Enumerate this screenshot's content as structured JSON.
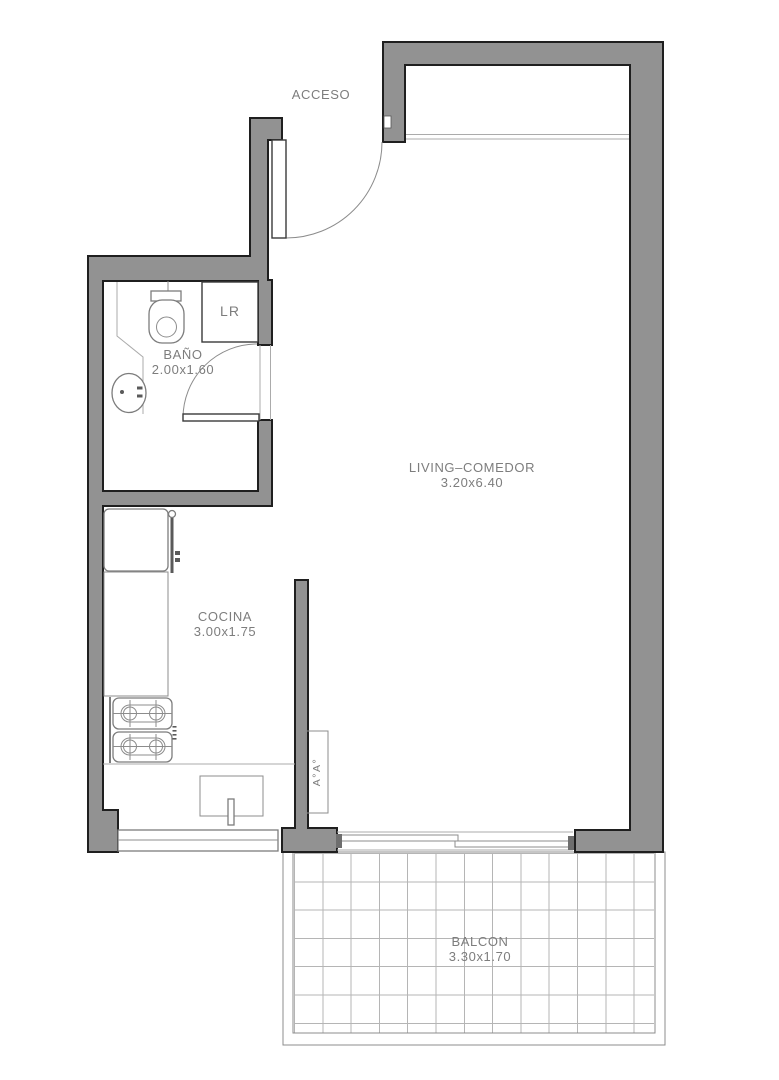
{
  "plan": {
    "entry_label": "ACCESO",
    "rooms": {
      "bathroom": {
        "name": "BAÑO",
        "dims": "2.00x1.60"
      },
      "living": {
        "name": "LIVING–COMEDOR",
        "dims": "3.20x6.40"
      },
      "kitchen": {
        "name": "COCINA",
        "dims": "3.00x1.75"
      },
      "balcony": {
        "name": "BALCON",
        "dims": "3.30x1.70"
      }
    },
    "fixtures": {
      "closet": "LR",
      "ac_unit": "A°A°"
    },
    "colors": {
      "wall_fill": "#929292",
      "wall_outline": "#1f1f1f",
      "detail_line": "#7c7c7c",
      "label_text": "#7d7d7d",
      "grid_line": "#b5b5b5",
      "background": "#ffffff"
    }
  }
}
